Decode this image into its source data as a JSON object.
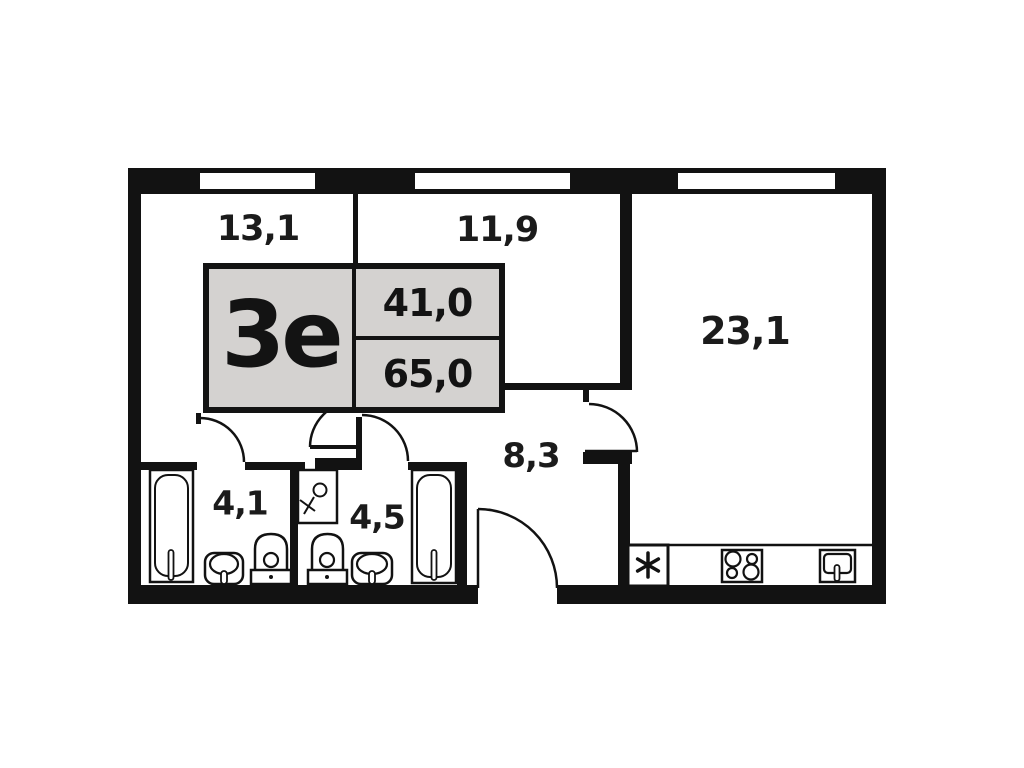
{
  "title": "apartment-floor-plan",
  "stamp": {
    "code": "3е",
    "area_upper": "41,0",
    "area_lower": "65,0"
  },
  "rooms": [
    {
      "id": "room-13-1",
      "label": "13,1"
    },
    {
      "id": "room-11-9",
      "label": "11,9"
    },
    {
      "id": "room-23-1",
      "label": "23,1"
    },
    {
      "id": "hall-8-3",
      "label": "8,3"
    },
    {
      "id": "bath-4-1",
      "label": "4,1"
    },
    {
      "id": "bath-4-5",
      "label": "4,5"
    }
  ],
  "icons": [
    "bathtub-icon",
    "toilet-icon",
    "sink-icon",
    "washing-machine-icon",
    "stove-icon",
    "kitchen-sink-icon",
    "asterisk-appliance-icon",
    "door-arc-icon",
    "window-icon"
  ],
  "colors": {
    "wall": "#121212",
    "stamp_fill": "#d4d2d0",
    "background": "#ffffff"
  }
}
